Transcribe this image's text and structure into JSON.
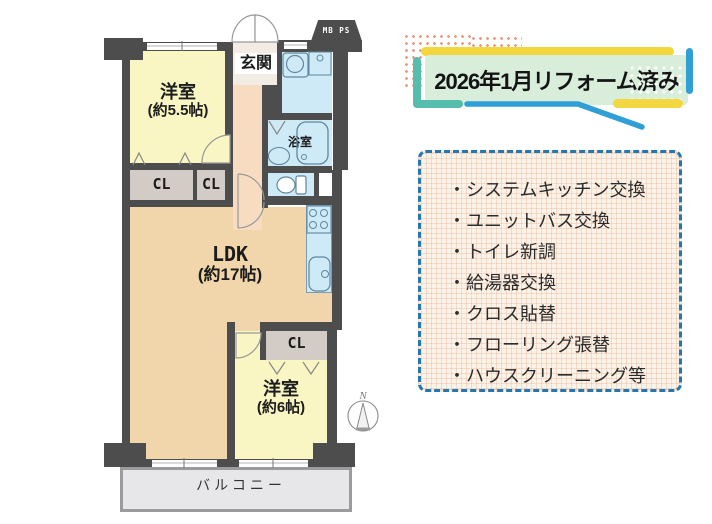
{
  "badge": {
    "title": "2026年1月リフォーム済み"
  },
  "renovation": {
    "bullet": "・",
    "items": [
      "システムキッチン交換",
      "ユニットバス交換",
      "トイレ新調",
      "給湯器交換",
      "クロス貼替",
      "フローリング張替",
      "ハウスクリーニング等"
    ]
  },
  "floorplan": {
    "mb_ps": "MB PS",
    "genkan": "玄関",
    "western_room_1": {
      "name": "洋室",
      "size": "(約5.5帖)"
    },
    "bathroom": "浴室",
    "closet": "CL",
    "ldk": {
      "name": "LDK",
      "size": "(約17帖)"
    },
    "western_room_2": {
      "name": "洋室",
      "size": "(約6帖)"
    },
    "balcony": "バルコニー",
    "compass_north": "N"
  },
  "colors": {
    "wall": "#4d4d4d",
    "room_yellow": "#f9f6c4",
    "ldk_tan": "#f0d6aa",
    "hall_pink": "#f7dcc2",
    "water_blue": "#cdeaf6",
    "closet_gray": "#d3cbc5",
    "balcony_gray": "#e7e7ea",
    "badge_green": "#d8eedb",
    "accent_yellow": "#f3d73e",
    "accent_teal": "#56bcab",
    "accent_blue": "#2f9fd6",
    "dashed_border": "#2478b0",
    "memo_cream": "#fbf3e8"
  }
}
